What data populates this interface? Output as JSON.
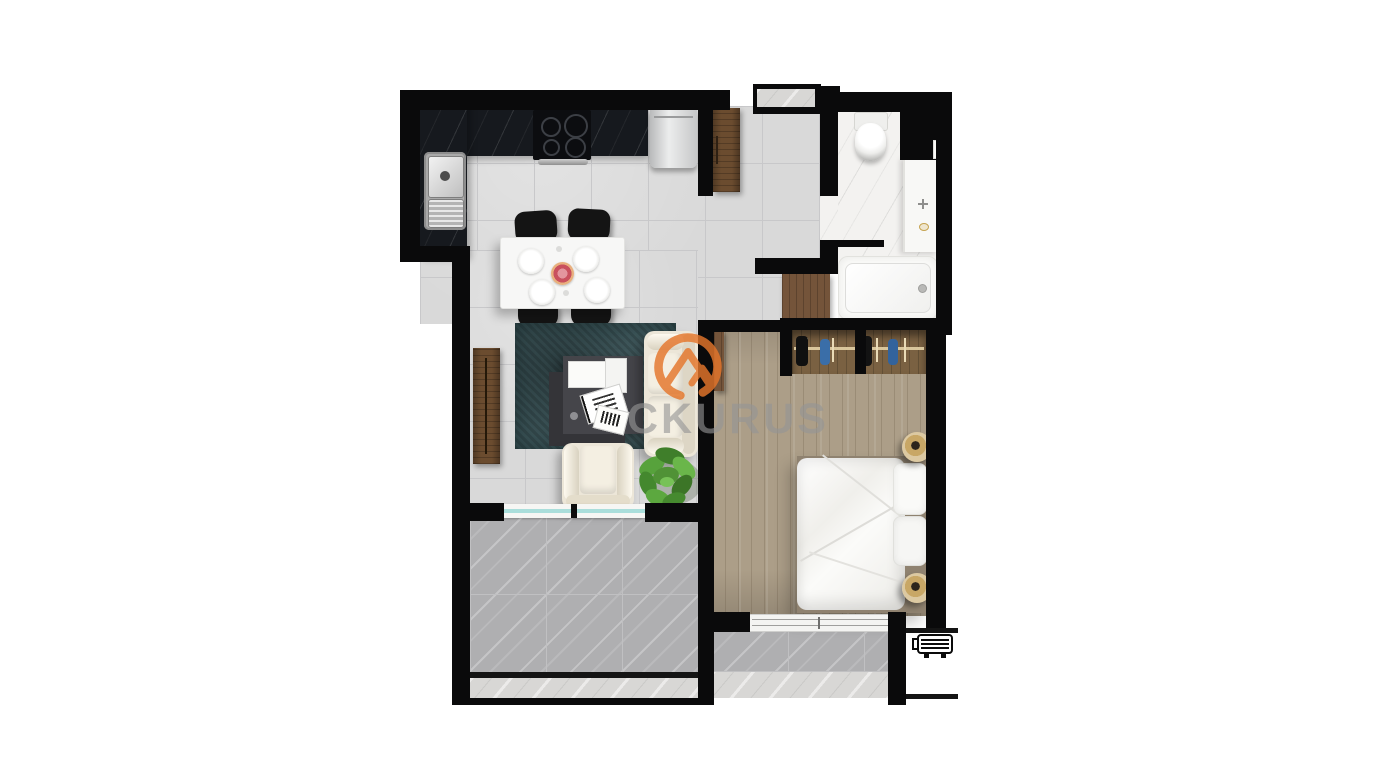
{
  "canvas": {
    "width": 1400,
    "height": 780,
    "background": "#ffffff"
  },
  "watermark": {
    "visible_text": "CKURUS",
    "logo": "mountain-in-circle",
    "logo_color": "#e5762b",
    "text_color": "#949494"
  },
  "scene": {
    "type": "apartment-floor-plan-top-view",
    "rooms": [
      "kitchen",
      "dining-area",
      "living-room",
      "hallway",
      "bathroom",
      "bedroom",
      "balcony",
      "lower-terrace"
    ],
    "furniture": [
      "kitchen-counter",
      "cooktop",
      "kitchen-sink",
      "appliance",
      "tall-cabinet",
      "dining-table",
      "dining-chair",
      "tv-console",
      "area-rug",
      "coffee-table",
      "sofa",
      "armchair",
      "potted-plant",
      "hall-cabinet",
      "toilet",
      "vanity-sink",
      "bathtub",
      "open-wardrobe",
      "double-bed",
      "bedside-lamp",
      "window",
      "sliding-glass-door",
      "ac-outdoor-unit"
    ],
    "colors": {
      "wall": "#0a0a0b",
      "tile_floor": "#d9d9d9",
      "wood_floor": "#ac9e88",
      "balcony_marble": "#afafb1",
      "bathroom_marble": "#f3f2f0",
      "counter_marble": "#16191e",
      "rug": "#3e575b",
      "upholstery": "#ece6d8",
      "cabinet_wood": "#6b4c2f",
      "plant": "#4f8f37",
      "glass_door": "#aadedb"
    }
  }
}
